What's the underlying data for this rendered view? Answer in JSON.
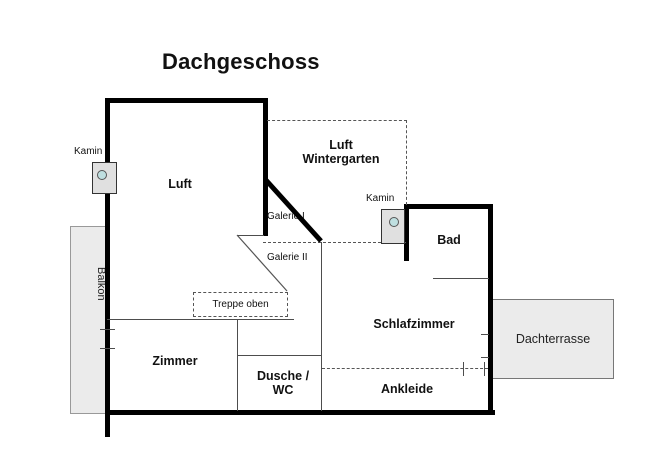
{
  "title": "Dachgeschoss",
  "rooms": {
    "luft": "Luft",
    "luft_wintergarten": "Luft\nWintergarten",
    "bad": "Bad",
    "schlafzimmer": "Schlafzimmer",
    "ankleide": "Ankleide",
    "zimmer": "Zimmer",
    "dusche_wc": "Dusche /\nWC"
  },
  "outdoor": {
    "balkon": "Balkon",
    "dachterrasse": "Dachterrasse"
  },
  "annotations": {
    "kamin_left": "Kamin",
    "kamin_right": "Kamin",
    "galerie_1": "Galerie I",
    "galerie_2": "Galerie II",
    "treppe_oben": "Treppe oben"
  },
  "colors": {
    "wall": "#000000",
    "thin_line": "#4d4d4d",
    "dashed_line": "#555555",
    "outdoor_fill": "#ebebeb",
    "kamin_fill": "#e0e0e0",
    "kamin_circle": "#bfdfe0",
    "background": "#ffffff",
    "text": "#111111"
  }
}
